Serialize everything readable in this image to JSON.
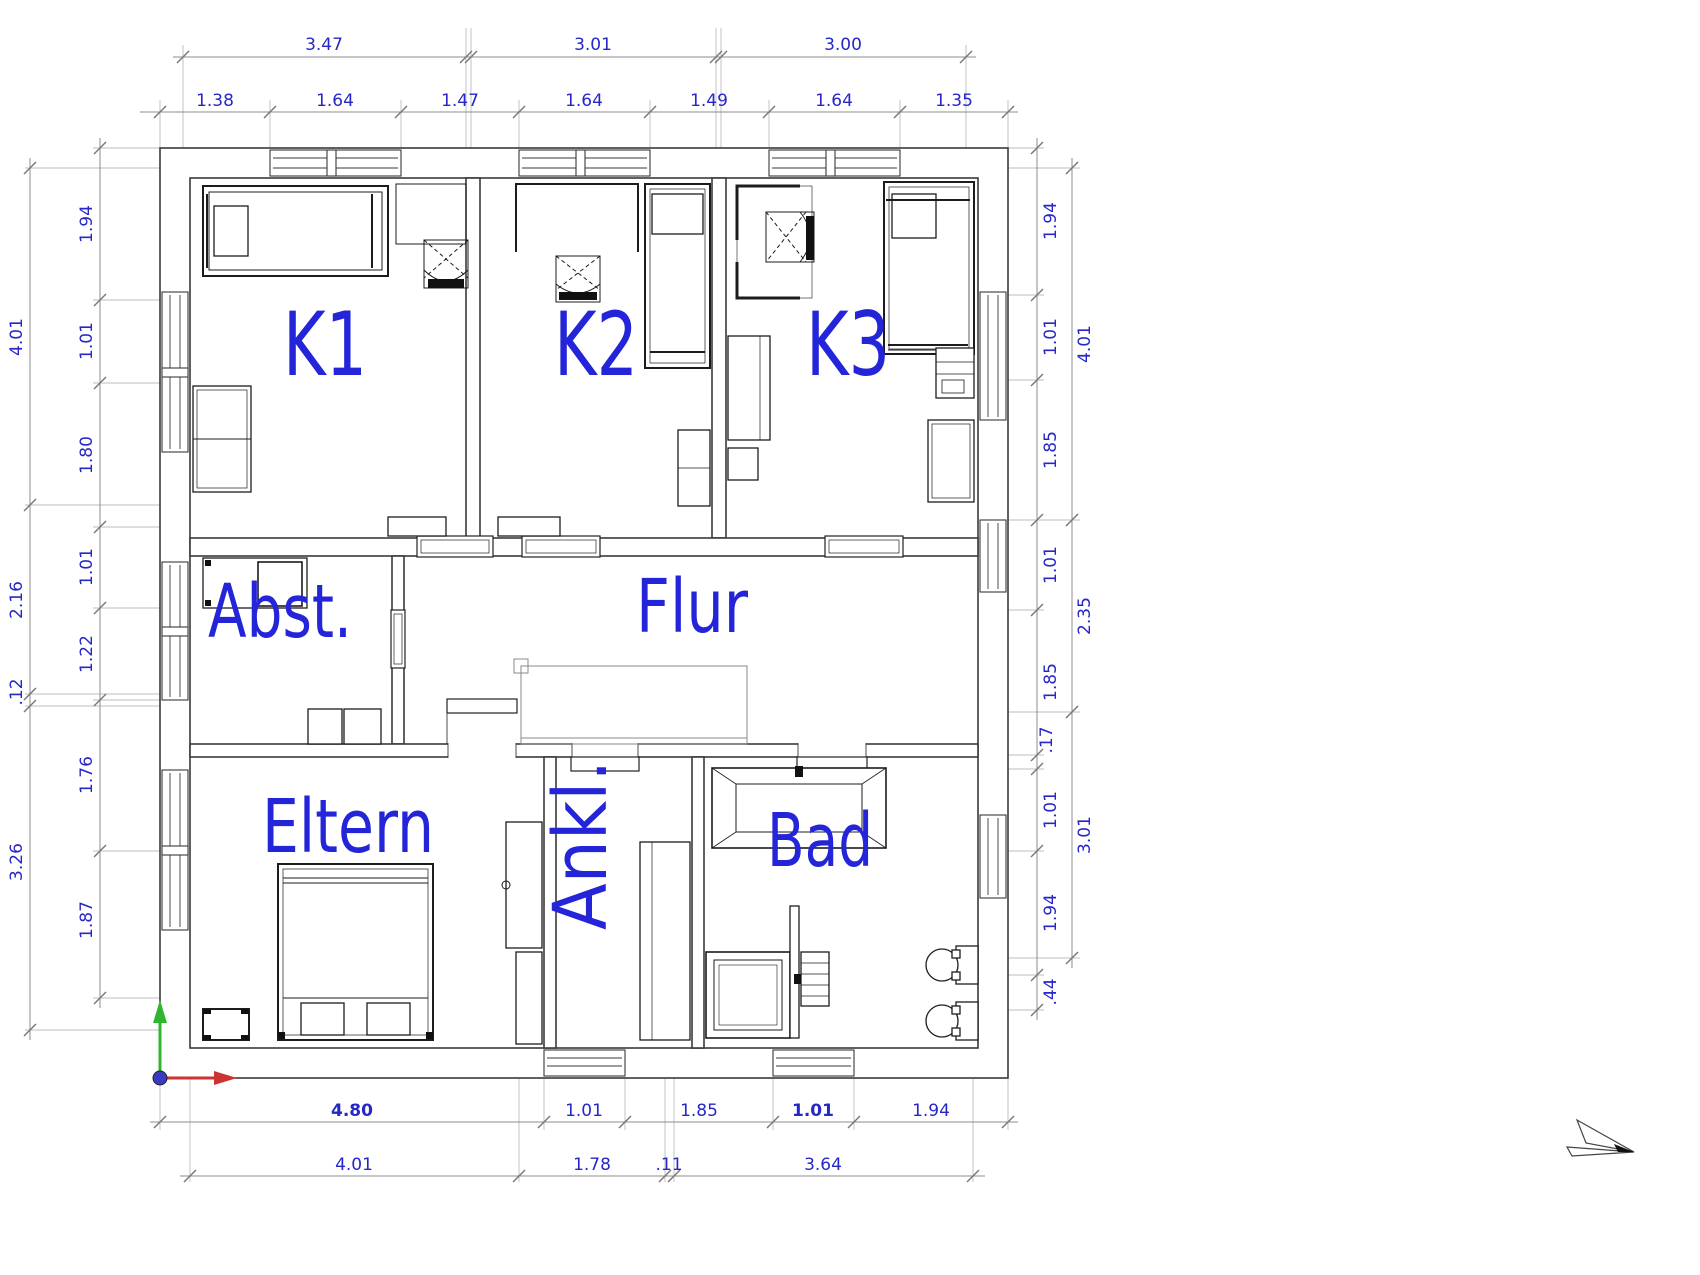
{
  "drawing": {
    "type": "architectural-floor-plan",
    "rooms": [
      {
        "id": "k1",
        "label": "K1"
      },
      {
        "id": "k2",
        "label": "K2"
      },
      {
        "id": "k3",
        "label": "K3"
      },
      {
        "id": "abst",
        "label": "Abst."
      },
      {
        "id": "flur",
        "label": "Flur"
      },
      {
        "id": "eltern",
        "label": "Eltern"
      },
      {
        "id": "ankl",
        "label": "Ankl."
      },
      {
        "id": "bad",
        "label": "Bad"
      }
    ],
    "dims": {
      "top_outer": [
        "3.47",
        "3.01",
        "3.00"
      ],
      "top_inner": [
        "1.38",
        "1.64",
        "1.47",
        "1.64",
        "1.49",
        "1.64",
        "1.35"
      ],
      "left_outer": [
        "4.01",
        "2.16",
        ".12",
        "3.26"
      ],
      "left_inner": [
        "1.94",
        "1.01",
        "1.80",
        "1.01",
        "1.22",
        "1.76",
        "1.87"
      ],
      "right_outer": [
        "4.01",
        "2.35",
        "3.01"
      ],
      "right_inner": [
        "1.94",
        "1.01",
        "1.85",
        "1.01",
        "1.85",
        ".17",
        "1.01",
        "1.94",
        ".44"
      ],
      "bottom_outer": [
        "4.80",
        "1.01",
        "1.85",
        "1.01",
        "1.94"
      ],
      "bottom_inner": [
        "4.01",
        "1.78",
        ".11",
        "3.64"
      ]
    },
    "colors": {
      "room_label_blue": "#2424d8",
      "dimension_blue": "#2727c8",
      "wall_line": "#3a3a3a",
      "dim_line_gray": "#8c8c8c",
      "axis_x_red": "#cc3333",
      "axis_y_green": "#2fb52f",
      "origin_dot_blue": "#3a3ac0"
    }
  }
}
